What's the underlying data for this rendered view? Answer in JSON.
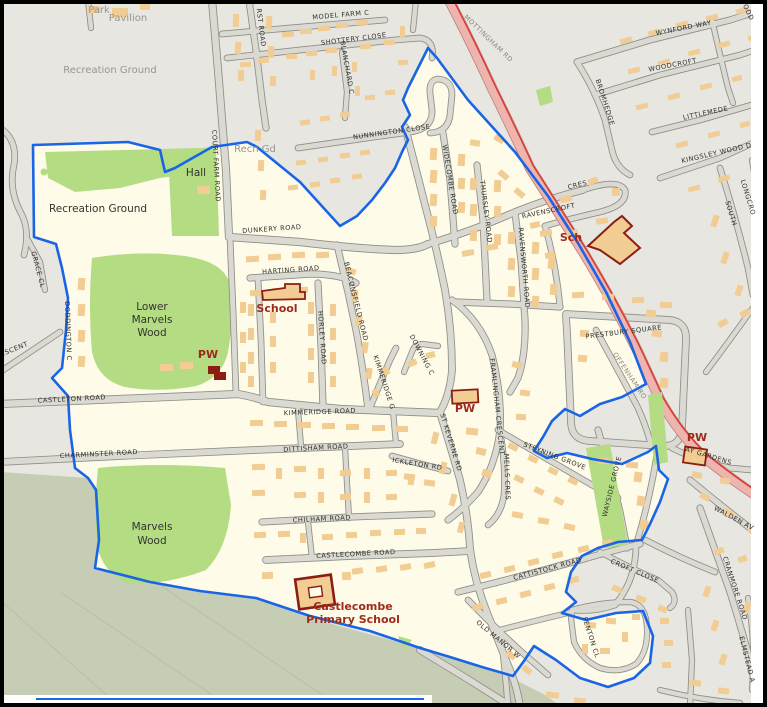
{
  "map": {
    "title": "Street map with blue boundary outline",
    "colors": {
      "background": "#e7e6e1",
      "estate_cream": "#fffbe9",
      "woodland_green": "#b3dc83",
      "field_sage": "#c6cdb5",
      "road_fill": "#dadad3",
      "road_casing": "#8e8e86",
      "a_road_pink": "#eeb4ae",
      "a_road_red_line": "#d93a31",
      "building_tan": "#f1cc93",
      "poi_outline_red": "#8c1d12",
      "boundary_blue": "#1a64e6",
      "label_black": "#2e2e2a",
      "label_grey": "#97968f",
      "poi_red": "#9e2a1c"
    },
    "areas": {
      "woods": [
        "Recreation Ground",
        "Lower Marvels Wood",
        "Marvels Wood"
      ],
      "points_of_interest": [
        "School",
        "Sch",
        "PW",
        "PW",
        "PW",
        "Hall",
        "Castlecombe Primary School"
      ]
    },
    "labels": [
      {
        "t": "Park",
        "x": 99,
        "y": 13,
        "r": 0,
        "c": "placegrey"
      },
      {
        "t": "Pavilion",
        "x": 128,
        "y": 21,
        "r": 0,
        "c": "placegrey"
      },
      {
        "t": "Recreation Ground",
        "x": 110,
        "y": 73,
        "r": 0,
        "c": "placegrey"
      },
      {
        "t": "Recn Gd",
        "x": 255,
        "y": 152,
        "r": 0,
        "c": "placegrey"
      },
      {
        "t": "Recreation Ground",
        "x": 98,
        "y": 212,
        "r": 0,
        "c": "place"
      },
      {
        "t": "Hall",
        "x": 196,
        "y": 176,
        "r": 0,
        "c": "place"
      },
      {
        "t": "Lower",
        "x": 152,
        "y": 310,
        "r": 0,
        "c": "place"
      },
      {
        "t": "Marvels",
        "x": 152,
        "y": 323,
        "r": 0,
        "c": "place"
      },
      {
        "t": "Wood",
        "x": 152,
        "y": 336,
        "r": 0,
        "c": "place"
      },
      {
        "t": "Marvels",
        "x": 152,
        "y": 530,
        "r": 0,
        "c": "place"
      },
      {
        "t": "Wood",
        "x": 152,
        "y": 544,
        "r": 0,
        "c": "place"
      },
      {
        "t": "School",
        "x": 277,
        "y": 312,
        "r": 0,
        "c": "poi"
      },
      {
        "t": "PW",
        "x": 208,
        "y": 358,
        "r": 0,
        "c": "poi"
      },
      {
        "t": "PW",
        "x": 465,
        "y": 412,
        "r": 0,
        "c": "poi"
      },
      {
        "t": "Sch",
        "x": 571,
        "y": 241,
        "r": 0,
        "c": "poi"
      },
      {
        "t": "PW",
        "x": 697,
        "y": 441,
        "r": 0,
        "c": "poi"
      },
      {
        "t": "Castlecombe",
        "x": 353,
        "y": 610,
        "r": 0,
        "c": "poi"
      },
      {
        "t": "Primary School",
        "x": 353,
        "y": 623,
        "r": 0,
        "c": "poi"
      },
      {
        "t": "MODEL FARM C",
        "x": 341,
        "y": 17,
        "r": -5,
        "c": "road"
      },
      {
        "t": "SHOTTERY CLOSE",
        "x": 354,
        "y": 41,
        "r": -7,
        "c": "road"
      },
      {
        "t": "RST ROAD",
        "x": 259,
        "y": 28,
        "r": 83,
        "c": "road"
      },
      {
        "t": "BLANCHARD C",
        "x": 345,
        "y": 68,
        "r": 80,
        "c": "road"
      },
      {
        "t": "NUNNINGTON CLOSE",
        "x": 392,
        "y": 134,
        "r": -8,
        "c": "road"
      },
      {
        "t": "MOTTINGHAM RD",
        "x": 487,
        "y": 40,
        "r": 44,
        "c": "roadlt"
      },
      {
        "t": "WYNFORD WAY",
        "x": 684,
        "y": 30,
        "r": -11,
        "c": "road"
      },
      {
        "t": "WOODCROFT",
        "x": 673,
        "y": 67,
        "r": -11,
        "c": "road"
      },
      {
        "t": "LITTLEMEDE",
        "x": 706,
        "y": 115,
        "r": -12,
        "c": "road"
      },
      {
        "t": "KINGSLEY WOOD D",
        "x": 717,
        "y": 155,
        "r": -13,
        "c": "road"
      },
      {
        "t": "BROMHEDGE",
        "x": 603,
        "y": 103,
        "r": 72,
        "c": "road"
      },
      {
        "t": "WOOD",
        "x": 745,
        "y": 10,
        "r": 65,
        "c": "road"
      },
      {
        "t": "SOUTH",
        "x": 729,
        "y": 214,
        "r": 73,
        "c": "road"
      },
      {
        "t": "LONGCRO",
        "x": 746,
        "y": 198,
        "r": 73,
        "c": "road"
      },
      {
        "t": "COURT FARM ROAD",
        "x": 214,
        "y": 166,
        "r": 87,
        "c": "road"
      },
      {
        "t": "DUNKERY ROAD",
        "x": 272,
        "y": 231,
        "r": -4,
        "c": "road"
      },
      {
        "t": "WIDECOMBE ROAD",
        "x": 448,
        "y": 180,
        "r": 81,
        "c": "road"
      },
      {
        "t": "THURSLEY ROAD",
        "x": 484,
        "y": 212,
        "r": 83,
        "c": "road"
      },
      {
        "t": "RAVENSWORTH ROAD",
        "x": 522,
        "y": 268,
        "r": 85,
        "c": "road"
      },
      {
        "t": "CRES",
        "x": 578,
        "y": 187,
        "r": -14,
        "c": "road"
      },
      {
        "t": "RAVENSCROFT",
        "x": 549,
        "y": 213,
        "r": -12,
        "c": "road"
      },
      {
        "t": "HARTING ROAD",
        "x": 291,
        "y": 272,
        "r": -4,
        "c": "road"
      },
      {
        "t": "HORLEY ROAD",
        "x": 320,
        "y": 338,
        "r": 86,
        "c": "road"
      },
      {
        "t": "BEACONSFIELD ROAD",
        "x": 354,
        "y": 302,
        "r": 76,
        "c": "road"
      },
      {
        "t": "CASTLETON ROAD",
        "x": 72,
        "y": 401,
        "r": -3,
        "c": "road"
      },
      {
        "t": "CHARMINSTER ROAD",
        "x": 99,
        "y": 456,
        "r": -3,
        "c": "road"
      },
      {
        "t": "KIMMERIDGE ROAD",
        "x": 320,
        "y": 414,
        "r": -2,
        "c": "road"
      },
      {
        "t": "DITTISHAM ROAD",
        "x": 316,
        "y": 450,
        "r": -3,
        "c": "road"
      },
      {
        "t": "CHILHAM ROAD",
        "x": 322,
        "y": 521,
        "r": -3,
        "c": "road"
      },
      {
        "t": "CASTLECOMBE ROAD",
        "x": 356,
        "y": 556,
        "r": -3,
        "c": "road"
      },
      {
        "t": "DODDINGTON C",
        "x": 66,
        "y": 331,
        "r": 88,
        "c": "road"
      },
      {
        "t": "GRACE CL",
        "x": 36,
        "y": 270,
        "r": 75,
        "c": "road"
      },
      {
        "t": "ESCENT",
        "x": 15,
        "y": 351,
        "r": -22,
        "c": "road"
      },
      {
        "t": "KIMMERIDGE G",
        "x": 382,
        "y": 383,
        "r": 72,
        "c": "road"
      },
      {
        "t": "DOWNING C",
        "x": 420,
        "y": 356,
        "r": 62,
        "c": "road"
      },
      {
        "t": "FRAMLINGHAM CRESCENT",
        "x": 495,
        "y": 407,
        "r": 84,
        "c": "road"
      },
      {
        "t": "ST KEVERNE RD",
        "x": 449,
        "y": 443,
        "r": 73,
        "c": "road"
      },
      {
        "t": "ICKLETON RD",
        "x": 417,
        "y": 466,
        "r": 9,
        "c": "road"
      },
      {
        "t": "MELLS CRES",
        "x": 505,
        "y": 477,
        "r": 88,
        "c": "road"
      },
      {
        "t": "STEYNING GROVE",
        "x": 554,
        "y": 458,
        "r": 21,
        "c": "road"
      },
      {
        "t": "WAYSIDE GROVE",
        "x": 614,
        "y": 487,
        "r": -76,
        "c": "road"
      },
      {
        "t": "PRESTBURY SQUARE",
        "x": 624,
        "y": 334,
        "r": -7,
        "c": "road"
      },
      {
        "t": "OFFENHAM RO",
        "x": 628,
        "y": 377,
        "r": 56,
        "c": "roadlt"
      },
      {
        "t": "CATTISTOCK ROAD",
        "x": 548,
        "y": 571,
        "r": -15,
        "c": "road"
      },
      {
        "t": "OLD MANOR W",
        "x": 497,
        "y": 641,
        "r": 40,
        "c": "road"
      },
      {
        "t": "FENTON CL",
        "x": 589,
        "y": 638,
        "r": 72,
        "c": "road"
      },
      {
        "t": "CROFT CLOSE",
        "x": 634,
        "y": 573,
        "r": 23,
        "c": "road"
      },
      {
        "t": "WALDEN AV",
        "x": 733,
        "y": 520,
        "r": 28,
        "c": "road"
      },
      {
        "t": "CRANMORE ROAD",
        "x": 733,
        "y": 589,
        "r": 72,
        "c": "road"
      },
      {
        "t": "ELMSTEAD A",
        "x": 745,
        "y": 660,
        "r": 76,
        "c": "road"
      },
      {
        "t": "AY GARDENS",
        "x": 708,
        "y": 458,
        "r": 17,
        "c": "road"
      }
    ]
  }
}
